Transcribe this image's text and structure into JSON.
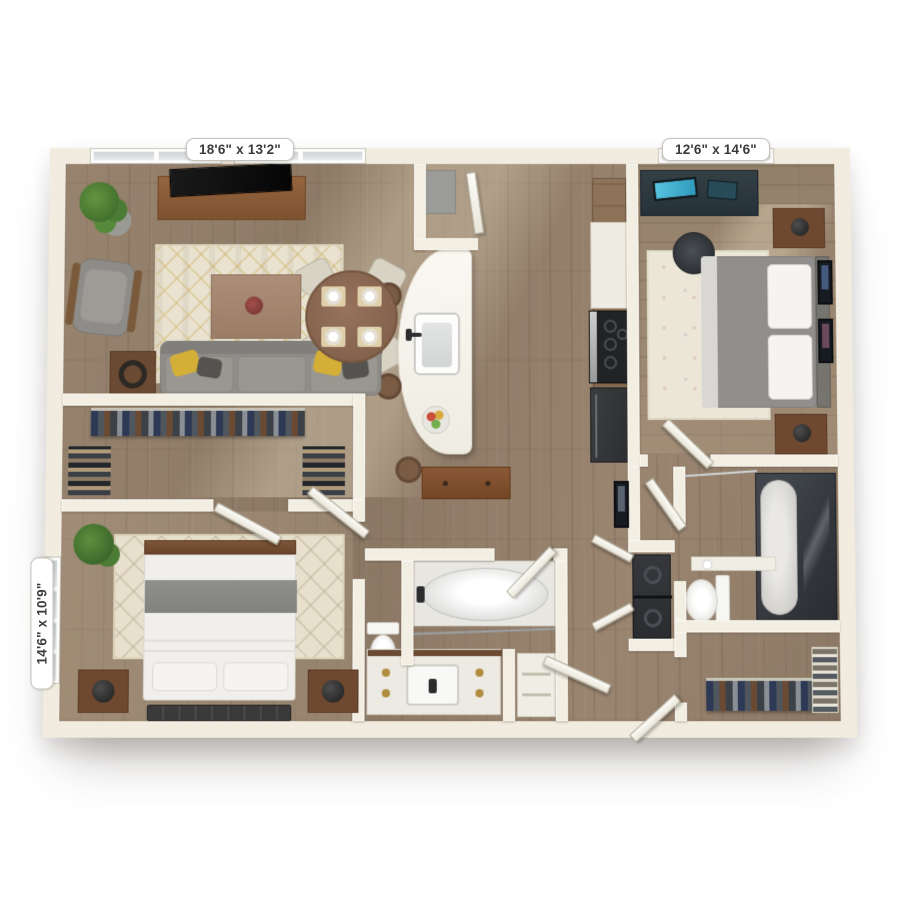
{
  "image": {
    "type": "3d-rendered-floor-plan",
    "description": "Top-down 3D rendering of a two-bedroom, two-bathroom apartment floor plan on a white background",
    "background_color": "#ffffff"
  },
  "labels": {
    "living_room": "18'6\" x 13'2\"",
    "bedroom_2": "12'6\" x 14'6\"",
    "bedroom_1": "14'6\" x 10'9\""
  },
  "rooms": [
    {
      "id": "living-room",
      "dimensions": "18'6\" x 13'2\"",
      "furniture": [
        "tv-console",
        "tv",
        "potted-plant",
        "armchair",
        "area-rug",
        "coffee-table",
        "sofa",
        "throw-pillows",
        "side-table",
        "round-dining-table",
        "dining-chairs",
        "place-settings"
      ]
    },
    {
      "id": "kitchen",
      "furniture": [
        "curved-island",
        "island-sink",
        "faucet",
        "fruit-bowl",
        "bar-stools",
        "pantry-closet",
        "wood-cabinets",
        "range-cooktop",
        "refrigerator"
      ]
    },
    {
      "id": "bedroom-2",
      "dimensions": "12'6\" x 14'6\"",
      "furniture": [
        "desk",
        "monitor",
        "office-chair",
        "area-rug",
        "bed",
        "pillows",
        "headboard",
        "nightstands",
        "lamps",
        "wall-art"
      ]
    },
    {
      "id": "walk-in-closet-1",
      "furniture": [
        "hanging-clothes",
        "shoe-shelves"
      ]
    },
    {
      "id": "bedroom-1",
      "dimensions": "14'6\" x 10'9\"",
      "furniture": [
        "potted-plant",
        "area-rug",
        "bed",
        "headboard",
        "gray-blanket",
        "pillows",
        "nightstands",
        "ball-lamps",
        "foot-bench",
        "floor-mats"
      ]
    },
    {
      "id": "bathroom-1",
      "furniture": [
        "bathtub",
        "shower-rod",
        "toilet",
        "vanity-sink",
        "linen-shelf"
      ]
    },
    {
      "id": "bathroom-2",
      "furniture": [
        "glass-shower-tub",
        "shower-rod",
        "toilet",
        "counter-ledge"
      ]
    },
    {
      "id": "laundry-closet",
      "furniture": [
        "stacked-washer-dryer",
        "bifold-doors"
      ]
    },
    {
      "id": "walk-in-closet-2",
      "furniture": [
        "hanging-clothes",
        "folded-shelving"
      ]
    },
    {
      "id": "hallway",
      "furniture": [
        "console-table",
        "wall-art",
        "entry-door"
      ]
    }
  ],
  "colors": {
    "background": "#ffffff",
    "walls": "#f1ecdf",
    "wood_floor": "#93806b",
    "wood_floor_light": "#a28d77",
    "rug_cream": "#e9e2d0",
    "accent_gold": "#d4af37",
    "sofa_gray": "#8f8d89",
    "wood_furniture": "#7a4b2e",
    "appliance_dark": "#303236",
    "plant_green": "#4e7d3a",
    "fixture_white": "#f4f4f2",
    "shower_glass": "#3a3e44",
    "door_white": "#f7f5ee",
    "label_background": "#ffffff",
    "label_text": "#3b3b3b"
  }
}
